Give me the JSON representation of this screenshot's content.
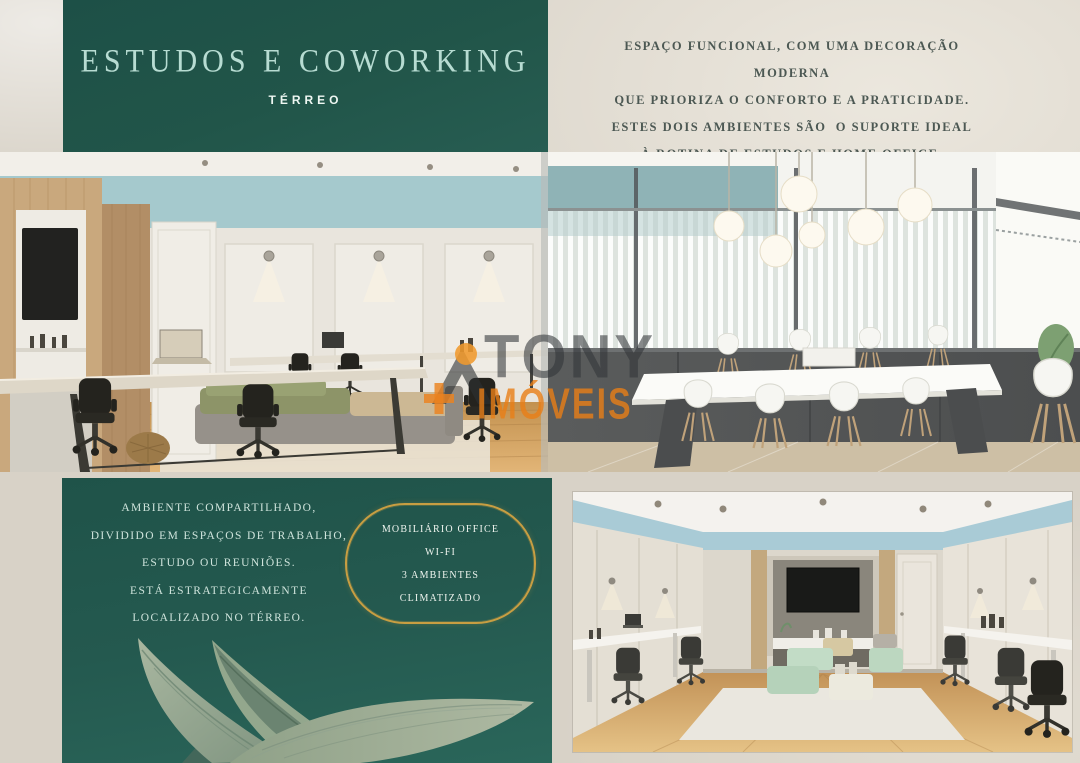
{
  "header": {
    "title": "ESTUDOS E COWORKING",
    "subtitle": "TÉRREO"
  },
  "intro": {
    "lines": [
      "ESPAÇO FUNCIONAL, COM UMA DECORAÇÃO MODERNA",
      "QUE PRIORIZA O CONFORTO E A PRATICIDADE.",
      "ESTES DOIS AMBIENTES SÃO  O SUPORTE IDEAL",
      "À ROTINA DE ESTUDOS E HOME OFFICE."
    ]
  },
  "description": {
    "lines": [
      "AMBIENTE COMPARTILHADO,",
      "DIVIDIDO EM ESPAÇOS DE TRABALHO,",
      "ESTUDO OU REUNIÕES.",
      "ESTÁ ESTRATEGICAMENTE",
      "LOCALIZADO NO TÉRREO."
    ]
  },
  "badge": {
    "lines": [
      "MOBILIÁRIO OFFICE",
      "WI-FI",
      "3 AMBIENTES",
      "CLIMATIZADO"
    ]
  },
  "watermark": {
    "name": "TONY",
    "category": "IMÓVEIS"
  },
  "colors": {
    "panel_teal": "#215549",
    "panel_teal_light": "#2a665a",
    "title_text": "#b7dcd2",
    "intro_text": "#4c5853",
    "description_text": "#cfe4dc",
    "gold": "#c89e42",
    "watermark_orange": "#e97e16",
    "watermark_gray": "#323638",
    "background_beige": "#d8d2c7",
    "photo_teal_band": "#a5c9cd",
    "leaf_green": "#9fb098"
  }
}
